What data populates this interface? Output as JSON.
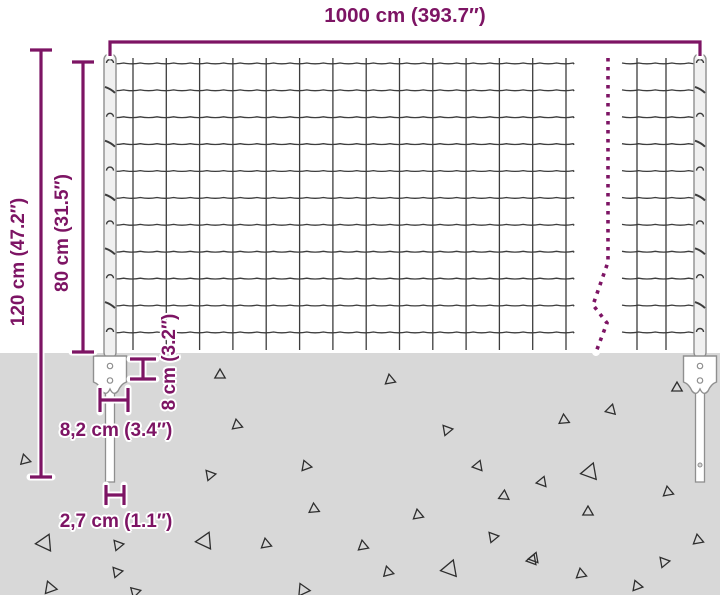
{
  "title": "Fence panel dimension diagram",
  "colors": {
    "accent": "#7d1464",
    "mesh": "#3d3d3d",
    "ground": "#d8d8d8",
    "post_fill": "#f0f0f0",
    "post_stroke": "#8f8f8f",
    "triangle": "#2e2e2e",
    "background": "#ffffff"
  },
  "labels": {
    "total_width": "1000 cm (393.7″)",
    "total_height": "120 cm (47.2″)",
    "mesh_height": "80 cm (31.5″)",
    "anchor_plate_height": "8 cm (3.2″)",
    "anchor_plate_width": "8,2 cm (3.4″)",
    "post_width": "2,7 cm (1.1″)"
  },
  "ground_triangles": [
    {
      "x": 25,
      "y": 460,
      "r": 5,
      "a": 15
    },
    {
      "x": 220,
      "y": 375,
      "r": 5,
      "a": 0
    },
    {
      "x": 390,
      "y": 380,
      "r": 5,
      "a": 10
    },
    {
      "x": 447,
      "y": 430,
      "r": 5,
      "a": 40
    },
    {
      "x": 237,
      "y": 425,
      "r": 5,
      "a": 130
    },
    {
      "x": 306,
      "y": 466,
      "r": 5,
      "a": 140
    },
    {
      "x": 210,
      "y": 475,
      "r": 5,
      "a": 40
    },
    {
      "x": 478,
      "y": 466,
      "r": 5,
      "a": 100
    },
    {
      "x": 504,
      "y": 496,
      "r": 5,
      "a": 115
    },
    {
      "x": 314,
      "y": 509,
      "r": 5,
      "a": 5
    },
    {
      "x": 418,
      "y": 515,
      "r": 5,
      "a": 130
    },
    {
      "x": 205,
      "y": 541,
      "r": 8,
      "a": 215
    },
    {
      "x": 266,
      "y": 544,
      "r": 5,
      "a": 130
    },
    {
      "x": 363,
      "y": 546,
      "r": 5,
      "a": 10
    },
    {
      "x": 493,
      "y": 537,
      "r": 5,
      "a": 40
    },
    {
      "x": 388,
      "y": 572,
      "r": 5,
      "a": 135
    },
    {
      "x": 450,
      "y": 569,
      "r": 8,
      "a": 220
    },
    {
      "x": 534,
      "y": 558,
      "r": 5,
      "a": 100
    },
    {
      "x": 303,
      "y": 590,
      "r": 6,
      "a": 145
    },
    {
      "x": 45,
      "y": 543,
      "r": 8,
      "a": 215
    },
    {
      "x": 118,
      "y": 545,
      "r": 5,
      "a": 40
    },
    {
      "x": 50,
      "y": 588,
      "r": 6,
      "a": 140
    },
    {
      "x": 135,
      "y": 592,
      "r": 5,
      "a": 45
    },
    {
      "x": 117,
      "y": 572,
      "r": 5,
      "a": 40
    },
    {
      "x": 677,
      "y": 388,
      "r": 5,
      "a": 0
    },
    {
      "x": 611,
      "y": 410,
      "r": 5,
      "a": 105
    },
    {
      "x": 564,
      "y": 420,
      "r": 5,
      "a": 5
    },
    {
      "x": 590,
      "y": 472,
      "r": 8,
      "a": 220
    },
    {
      "x": 542,
      "y": 482,
      "r": 5,
      "a": 100
    },
    {
      "x": 668,
      "y": 492,
      "r": 5,
      "a": 130
    },
    {
      "x": 588,
      "y": 512,
      "r": 5,
      "a": 0
    },
    {
      "x": 698,
      "y": 540,
      "r": 5,
      "a": 10
    },
    {
      "x": 532,
      "y": 560,
      "r": 5,
      "a": 100
    },
    {
      "x": 664,
      "y": 562,
      "r": 5,
      "a": 40
    },
    {
      "x": 581,
      "y": 574,
      "r": 5,
      "a": 130
    },
    {
      "x": 637,
      "y": 586,
      "r": 5,
      "a": 140
    }
  ]
}
